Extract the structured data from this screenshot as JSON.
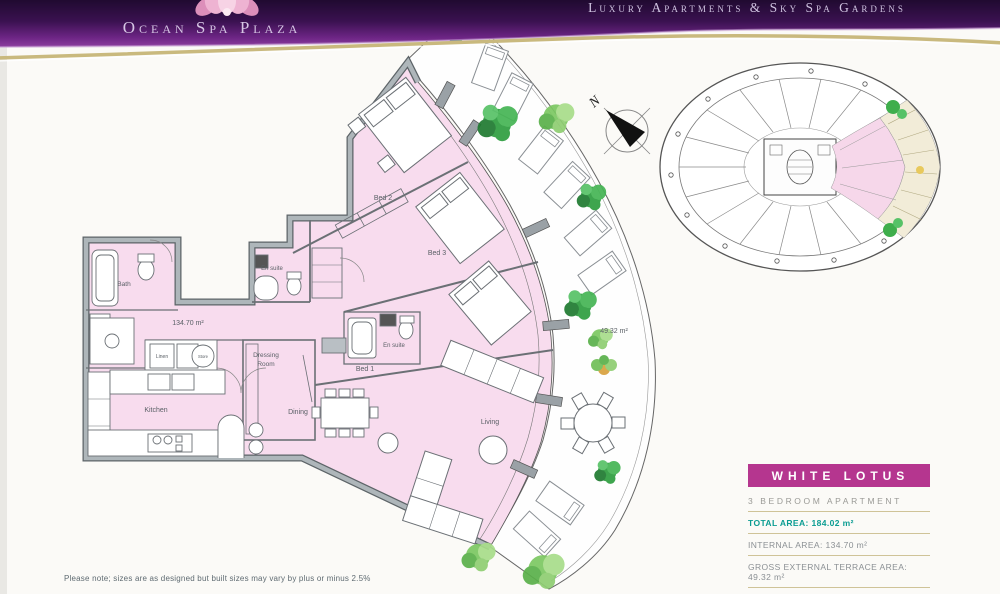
{
  "header": {
    "brand": "Ocean Spa Plaza",
    "tagline": "Luxury Apartments & Sky Spa Gardens"
  },
  "plan": {
    "labels": {
      "bed2": "Bed 2",
      "bed3": "Bed 3",
      "bed1": "Bed 1",
      "ensuite_bed2": "En suite",
      "ensuite_bed1": "En suite",
      "bath": "Bath",
      "linen": "Linen",
      "store": "Store",
      "dressing_line1": "Dressing",
      "dressing_line2": "Room",
      "kitchen": "Kitchen",
      "dining": "Dining",
      "living": "Living",
      "internal_area": "134.70 m²",
      "terrace_area": "49.32 m²",
      "north": "N"
    }
  },
  "info_panel": {
    "title": "WHITE LOTUS",
    "subtitle": "3 BEDROOM APARTMENT",
    "rows": [
      {
        "text": "TOTAL AREA: 184.02 m²"
      },
      {
        "text": "INTERNAL AREA: 134.70 m²"
      },
      {
        "text": "GROSS EXTERNAL TERRACE AREA: 49.32 m²"
      }
    ],
    "website": "www.oceanspaplaza.com"
  },
  "footnote": "Please note; sizes are as designed but built sizes may vary by plus or minus 2.5%",
  "colors": {
    "accent_pink": "#b5368f",
    "teal": "#0a9c92",
    "gold_line": "#c9b97e",
    "apartment_fill": "#f8dcee",
    "wall_gray": "#9aa1a6",
    "banner_purple": "#471563"
  }
}
